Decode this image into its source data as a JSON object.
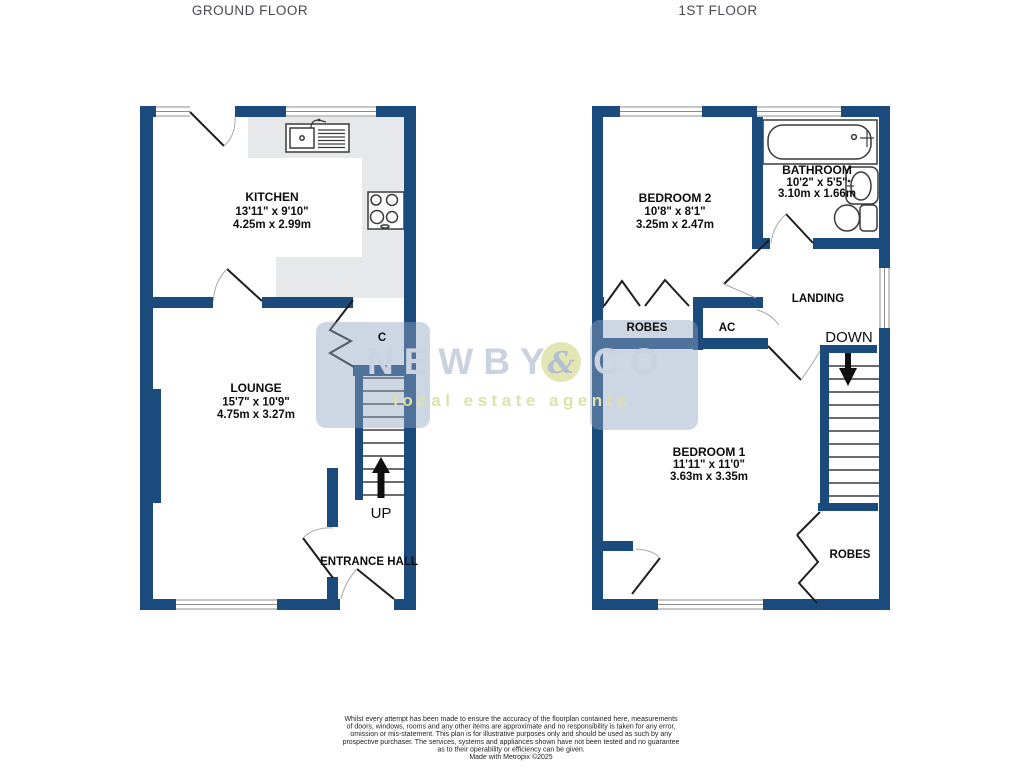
{
  "colors": {
    "navy": "#1b4a7c",
    "counter": "#e7e8e9",
    "fxstroke": "#3a3a3a",
    "winline": "#8c8c8c",
    "titlegray": "#4a4a52",
    "tile": "rgba(145,165,192,0.45)",
    "wmtext": "#c9d2de",
    "wamp": "#b3bfd0",
    "wmgreen": "#dde2a6"
  },
  "ground": {
    "title": "GROUND FLOOR",
    "rooms": {
      "kitchen": {
        "name": "KITCHEN",
        "imperial": "13'11\" x 9'10\"",
        "metric": "4.25m x 2.99m"
      },
      "lounge": {
        "name": "LOUNGE",
        "imperial": "15'7\" x 10'9\"",
        "metric": "4.75m x 3.27m"
      }
    },
    "labels": {
      "cupboard": "C",
      "up": "UP",
      "entrance": "ENTRANCE HALL"
    }
  },
  "first": {
    "title": "1ST FLOOR",
    "rooms": {
      "bedroom2": {
        "name": "BEDROOM 2",
        "imperial": "10'8\" x 8'1\"",
        "metric": "3.25m x 2.47m"
      },
      "bathroom": {
        "name": "BATHROOM",
        "imperial": "10'2\" x 5'5\"",
        "metric": "3.10m x 1.66m"
      },
      "bedroom1": {
        "name": "BEDROOM 1",
        "imperial": "11'11\" x 11'0\"",
        "metric": "3.63m x 3.35m"
      }
    },
    "labels": {
      "robes2": "ROBES",
      "ac": "AC",
      "landing": "LANDING",
      "down": "DOWN",
      "robes1": "ROBES"
    }
  },
  "watermark": {
    "name": "NEWBY",
    "amp": "&",
    "co": "CO",
    "tagline": "local estate agents"
  },
  "disclaimer": {
    "lines": [
      "Whilst every attempt has been made to ensure the accuracy of the floorplan contained here, measurements",
      "of doors, windows, rooms and any other items are approximate and no responsibility is taken for any error,",
      "omission or mis-statement. This plan is for illustrative purposes only and should be used as such by any",
      "prospective purchaser. The services, systems and appliances shown have not been tested and no guarantee",
      "as to their operability or efficiency can be given.",
      "Made with Metropix ©2025"
    ]
  }
}
